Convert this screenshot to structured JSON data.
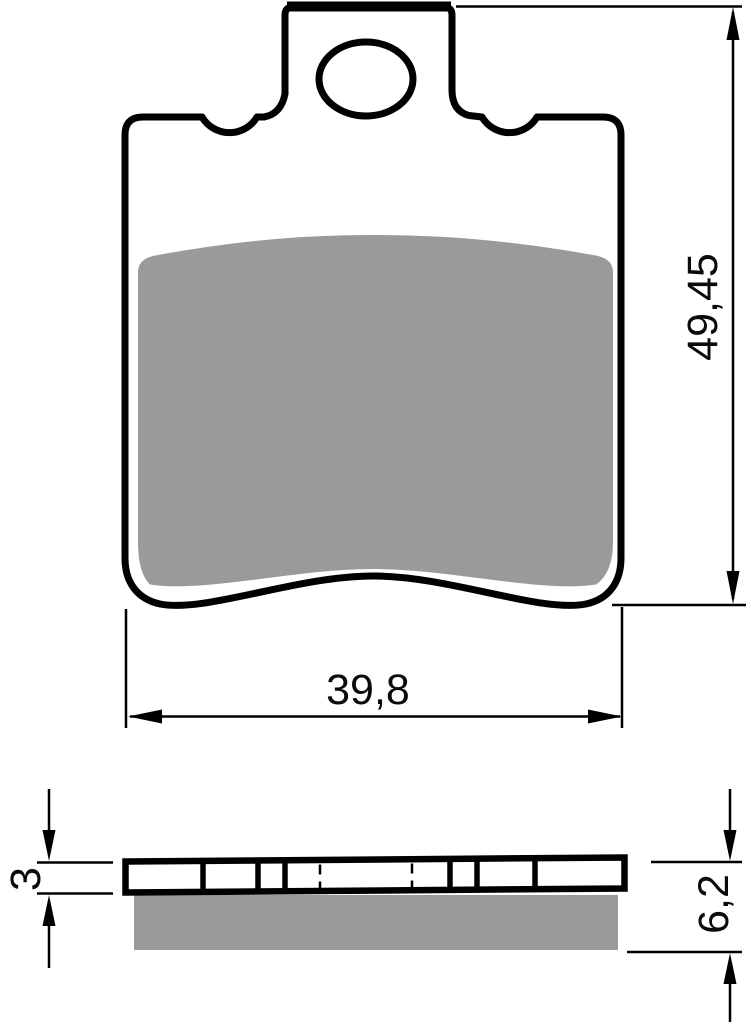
{
  "drawing": {
    "type": "technical-drawing",
    "subject": "brake pad front and side views with dimensions",
    "background_color": "#ffffff",
    "outline_color": "#000000",
    "friction_material_color": "#9a9a9a",
    "front_view": {
      "width_label": "39,8",
      "height_label": "49,45"
    },
    "side_view": {
      "backplate_thickness_label": "3",
      "total_thickness_label": "6,2"
    }
  }
}
